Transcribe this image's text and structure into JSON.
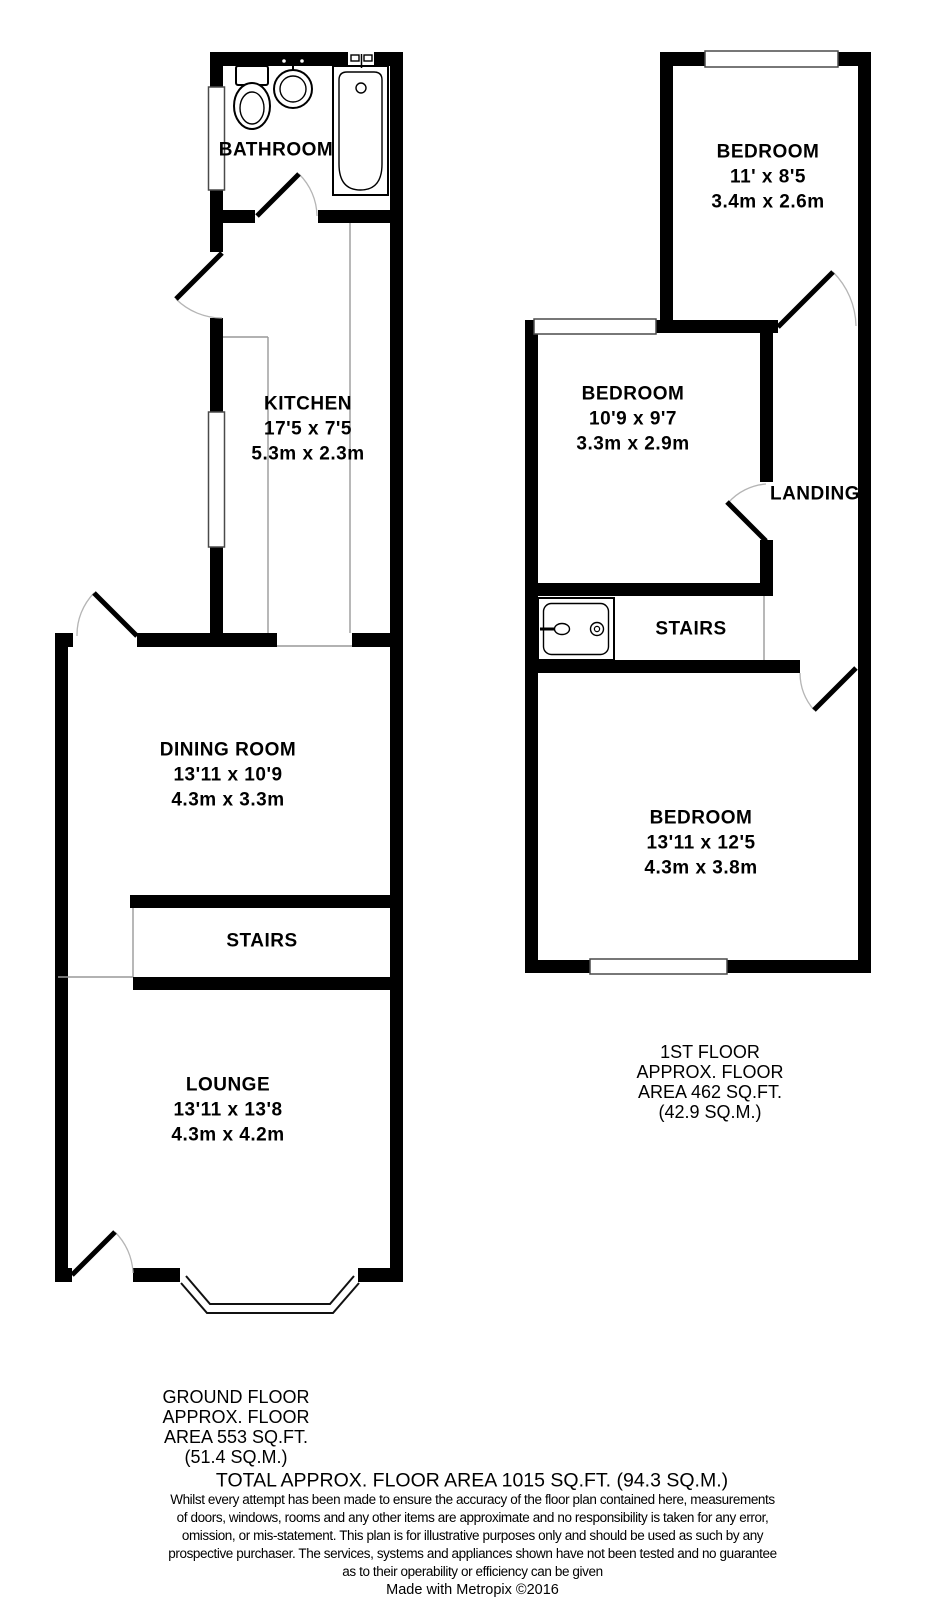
{
  "ground_floor": {
    "caption_lines": [
      "GROUND FLOOR",
      "APPROX. FLOOR",
      "AREA 553 SQ.FT.",
      "(51.4 SQ.M.)"
    ],
    "rooms": {
      "bathroom": {
        "name": "BATHROOM"
      },
      "kitchen": {
        "name": "KITCHEN",
        "size_imperial": "17'5 x 7'5",
        "size_metric": "5.3m x 2.3m"
      },
      "dining_room": {
        "name": "DINING ROOM",
        "size_imperial": "13'11 x 10'9",
        "size_metric": "4.3m x 3.3m"
      },
      "stairs": {
        "name": "STAIRS"
      },
      "lounge": {
        "name": "LOUNGE",
        "size_imperial": "13'11 x 13'8",
        "size_metric": "4.3m x 4.2m"
      }
    }
  },
  "first_floor": {
    "caption_lines": [
      "1ST FLOOR",
      "APPROX. FLOOR",
      "AREA 462 SQ.FT.",
      "(42.9 SQ.M.)"
    ],
    "rooms": {
      "bedroom_front": {
        "name": "BEDROOM",
        "size_imperial": "11' x 8'5",
        "size_metric": "3.4m x 2.6m"
      },
      "bedroom_middle": {
        "name": "BEDROOM",
        "size_imperial": "10'9 x 9'7",
        "size_metric": "3.3m x 2.9m"
      },
      "landing": {
        "name": "LANDING"
      },
      "stairs": {
        "name": "STAIRS"
      },
      "bedroom_rear": {
        "name": "BEDROOM",
        "size_imperial": "13'11 x 12'5",
        "size_metric": "4.3m x 3.8m"
      }
    }
  },
  "footer": {
    "total_area": "TOTAL APPROX. FLOOR AREA 1015 SQ.FT. (94.3 SQ.M.)",
    "disclaimer_lines": [
      "Whilst every attempt has been made to ensure the accuracy of the floor plan contained here, measurements",
      "of doors, windows, rooms and any other items are approximate and no responsibility is taken for any error,",
      "omission, or mis-statement. This plan is for illustrative purposes only and should be used as such by any",
      "prospective purchaser. The services, systems and appliances shown have not been tested and no guarantee",
      "as to their operability or efficiency can be given"
    ],
    "credit": "Made with Metropix ©2016"
  },
  "colors": {
    "wall": "#000000",
    "window_outline": "#4a4a4a",
    "thin_line": "#999999",
    "door_arc": "#b5b5b5",
    "background": "#ffffff",
    "text": "#000000"
  }
}
